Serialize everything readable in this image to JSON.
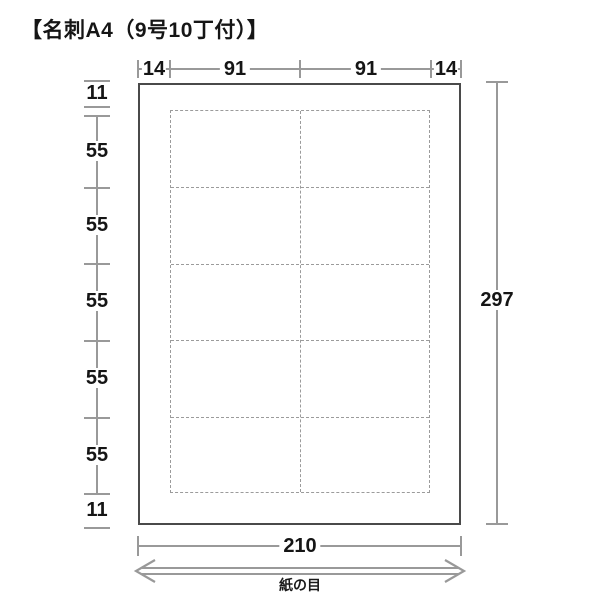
{
  "title": "【名刺A4（9号10丁付）】",
  "dimensions": {
    "top": [
      "14",
      "91",
      "91",
      "14"
    ],
    "left": [
      "11",
      "55",
      "55",
      "55",
      "55",
      "55",
      "11"
    ],
    "right_total": "297",
    "bottom_total": "210"
  },
  "grain": {
    "label": "紙の目"
  },
  "sheet": {
    "card_rows": 5,
    "card_cols": 2,
    "card_count": 10
  },
  "colors": {
    "dimension_line": "#999999",
    "dashed_grid": "#9b9b9b",
    "sheet_border": "#4a4a4a",
    "text": "#151515"
  }
}
